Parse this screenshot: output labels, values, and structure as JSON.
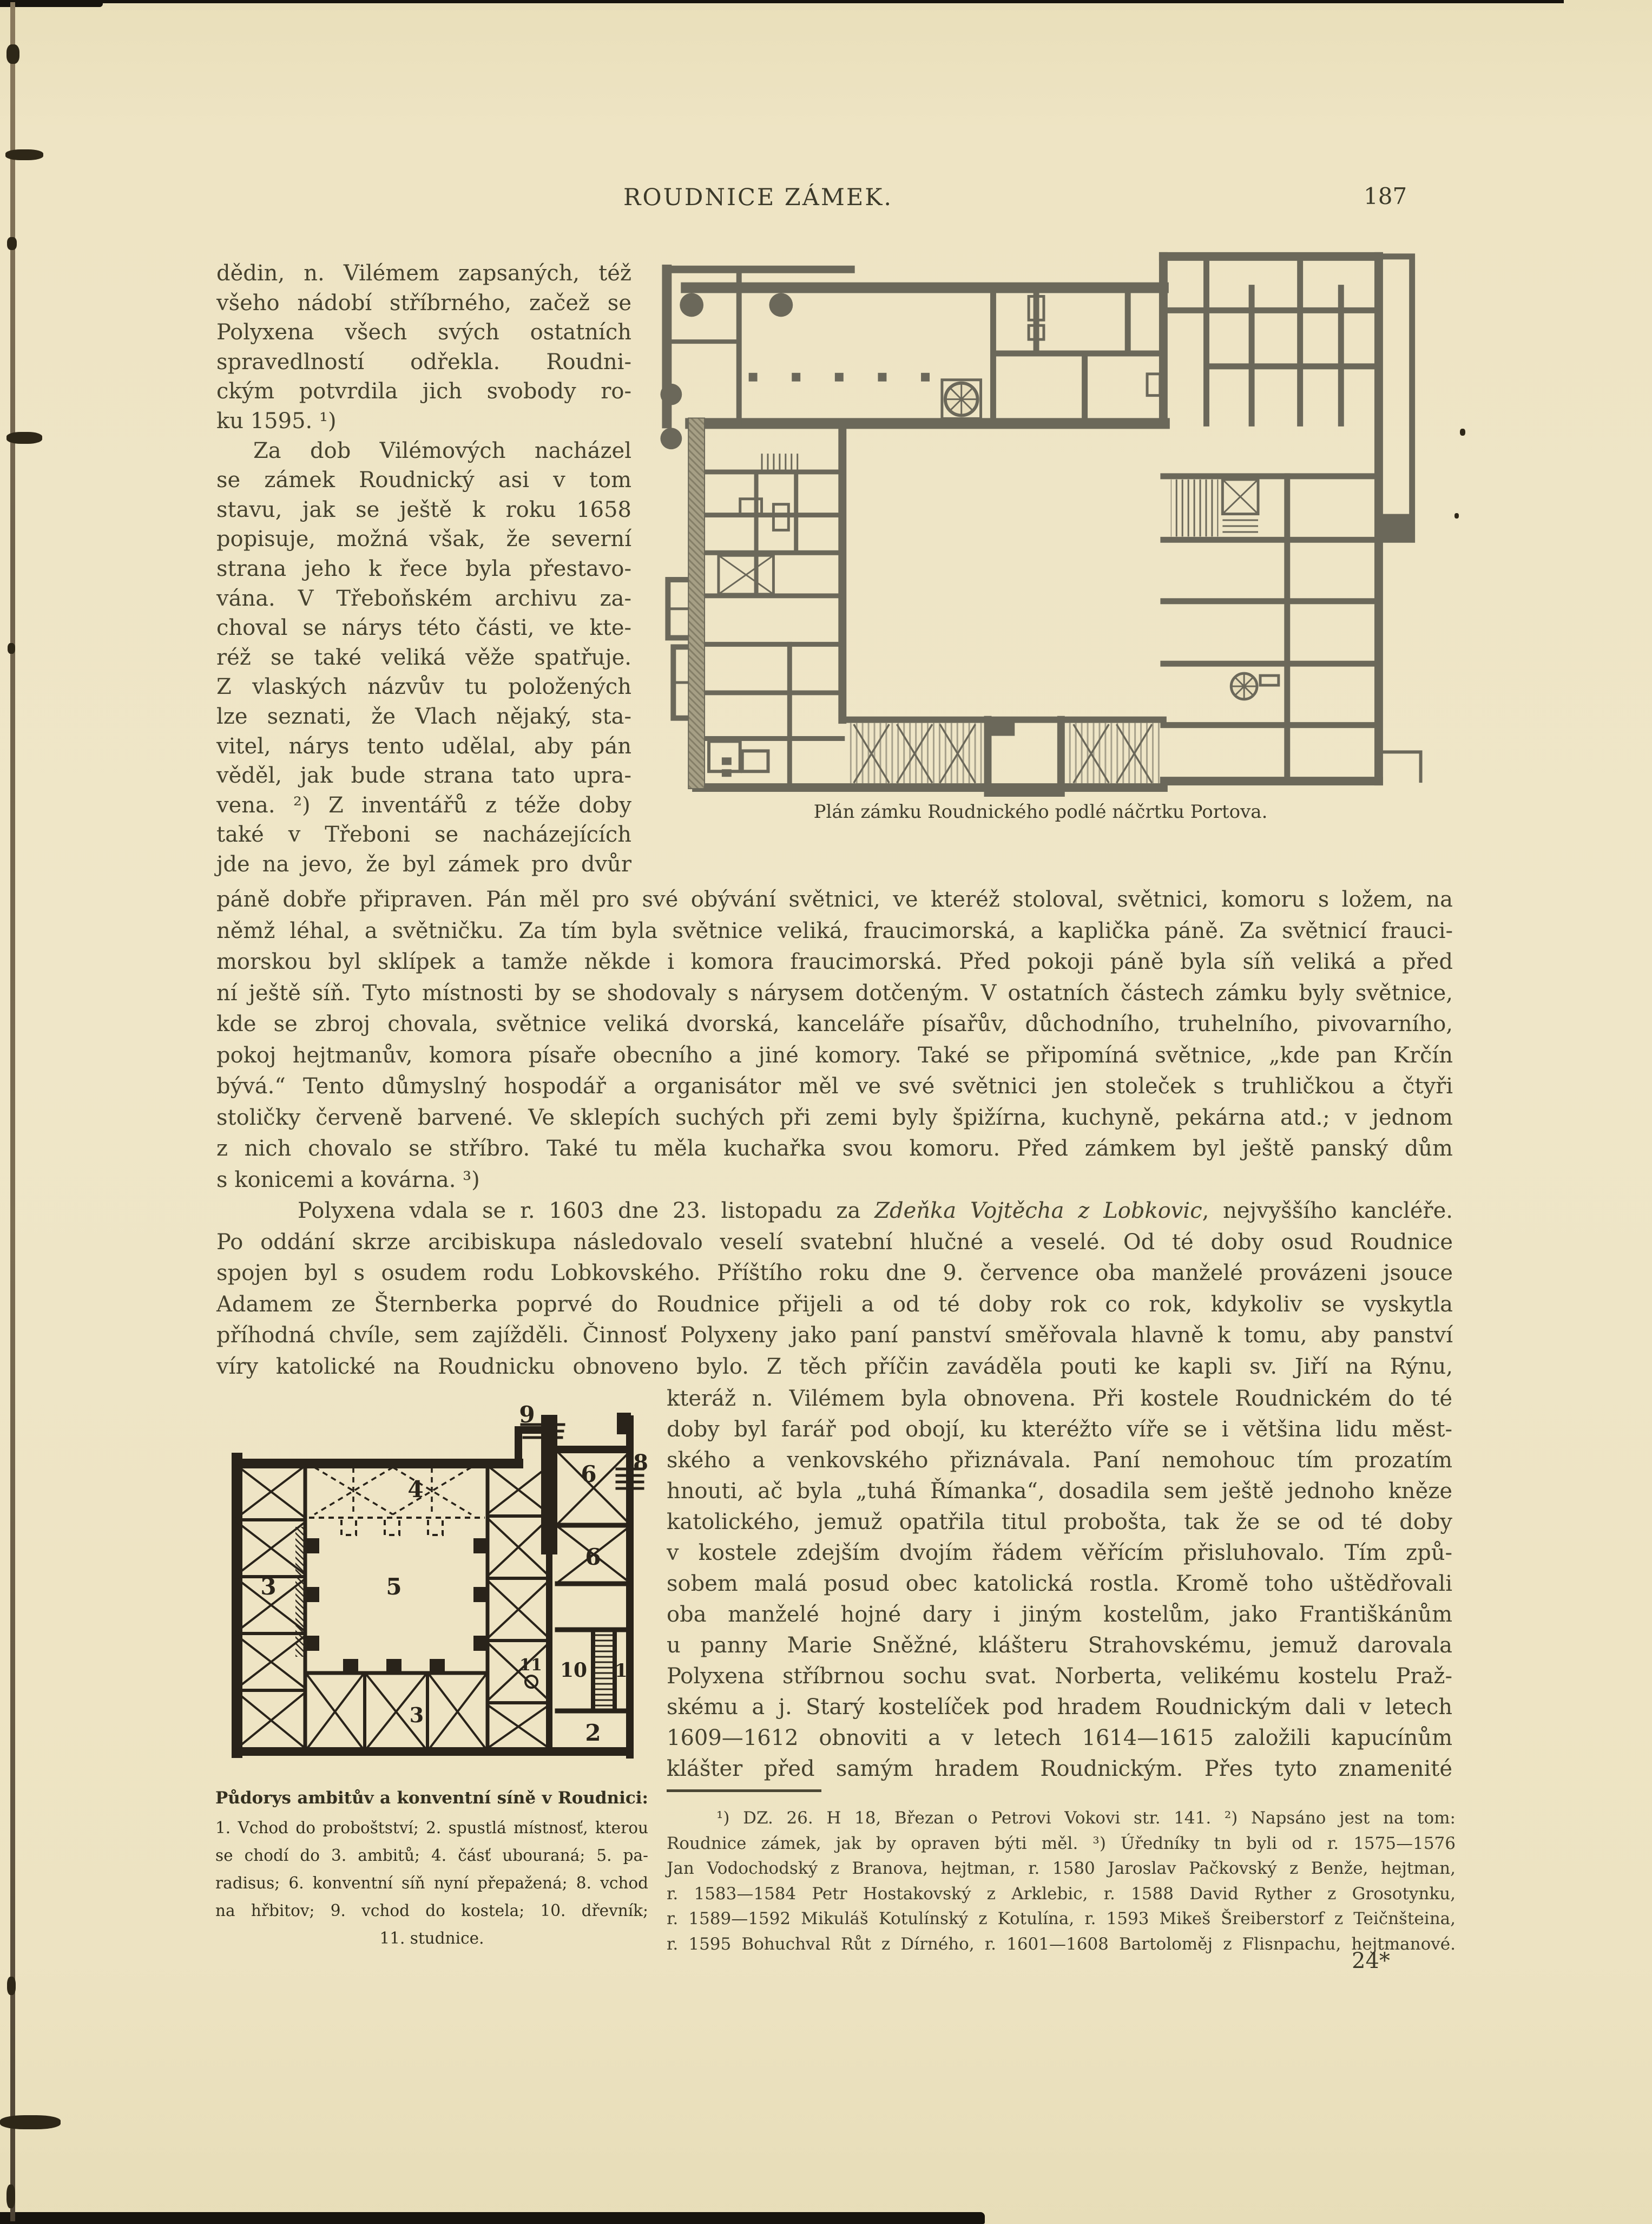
{
  "header": {
    "title": "ROUDNICE ZÁMEK.",
    "page_number": "187"
  },
  "colors": {
    "paper": "#eee4c4",
    "ink": "#46422f",
    "top_plan_wall": "#6b685a",
    "bottom_plan_wall": "#29231a"
  },
  "left_column": {
    "lines": [
      {
        "text": "dědin, n. Vilémem zapsaných, též"
      },
      {
        "text": "všeho nádobí stříbrného, začež se"
      },
      {
        "text": "Polyxena všech svých ostatních"
      },
      {
        "text": "spravedlností odřekla. Roudni-"
      },
      {
        "text": "ckým potvrdila jich svobody ro-"
      },
      {
        "text": "ku 1595. ¹)",
        "cls": "short"
      },
      {
        "text": "Za dob Vilémových nacházel",
        "cls": "indent"
      },
      {
        "text": "se zámek Roudnický asi v tom"
      },
      {
        "text": "stavu, jak se ještě k roku 1658"
      },
      {
        "text": "popisuje, možná však, že severní"
      },
      {
        "text": "strana jeho k řece byla přestavo-"
      },
      {
        "text": "vána. V Třeboňském archivu za-"
      },
      {
        "text": "choval se nárys této části, ve kte-"
      },
      {
        "text": "réž se také veliká věže spatřuje."
      },
      {
        "text": "Z vlaských názvův tu položených"
      },
      {
        "text": "lze seznati, že Vlach nějaký, sta-"
      },
      {
        "text": "vitel, nárys tento udělal, aby pán"
      },
      {
        "text": "věděl, jak bude strana tato upra-"
      },
      {
        "text": "vena. ²) Z inventářů z téže doby"
      },
      {
        "text": "také v Třeboni se nacházejících"
      },
      {
        "text": "jde na jevo, že byl zámek pro dvůr"
      }
    ]
  },
  "full_width": {
    "para1_lines": [
      {
        "text": "páně dobře připraven. Pán měl pro své obývání světnici, ve kteréž stoloval, světnici, komoru s ložem, na"
      },
      {
        "text": "němž léhal, a světničku. Za tím byla světnice veliká, fraucimorská, a kaplička páně. Za světnicí frauci-"
      },
      {
        "text": "morskou byl sklípek a tamže někde i komora fraucimorská. Před pokoji páně byla síň veliká a před"
      },
      {
        "text": "ní ještě síň. Tyto místnosti by se shodovaly s nárysem dotčeným. V ostatních částech zámku byly světnice,"
      },
      {
        "text": "kde se zbroj chovala, světnice veliká dvorská, kanceláře písařův, důchodního, truhelního, pivovarního,"
      },
      {
        "text": "pokoj hejtmanův, komora písaře obecního a jiné komory. Také se připomíná světnice, „kde pan Krčín"
      },
      {
        "text": "bývá.“ Tento důmyslný hospodář a organisátor měl ve své světnici jen stoleček s truhličkou a čtyři"
      },
      {
        "text": "stoličky červeně barvené. Ve sklepích suchých při zemi byly špižírna, kuchyně, pekárna atd.; v jednom"
      },
      {
        "text": "z nich chovalo se stříbro. Také tu měla kuchařka svou komoru. Před zámkem byl ještě panský dům"
      },
      {
        "text": "s konicemi a kovárna. ³)",
        "cls": "short"
      }
    ],
    "wedding_line": {
      "pre": "Polyxena vdala se r. 1603 dne 23. listopadu za ",
      "italic": "Zdeňka Vojtěcha z Lobkovic",
      "post": ", nejvyššího kancléře."
    },
    "para2_lines": [
      {
        "text": "Po oddání skrze arcibiskupa následovalo veselí svatební hlučné a veselé. Od té doby osud Roudnice"
      },
      {
        "text": "spojen byl s osudem rodu Lobkovského. Příštího roku dne 9. července oba manželé provázeni jsouce"
      },
      {
        "text": "Adamem ze Šternberka poprvé do Roudnice přijeli a od té doby rok co rok, kdykoliv se vyskytla"
      },
      {
        "text": "příhodná chvíle, sem zajížděli. Činnosť Polyxeny jako paní panství směřovala hlavně k tomu, aby panství"
      },
      {
        "text": "víry katolické na Roudnicku obnoveno bylo. Z těch příčin zaváděla pouti ke kapli sv. Jiří na Rýnu,"
      }
    ]
  },
  "right_column": {
    "lines": [
      {
        "text": "kteráž n. Vilémem byla obnovena. Při kostele Roudnickém do té"
      },
      {
        "text": "doby byl farář pod obojí, ku kteréžto víře se i většina lidu měst-"
      },
      {
        "text": "ského a venkovského přiznávala. Paní nemohouc tím prozatím"
      },
      {
        "text": "hnouti, ač byla „tuhá Římanka“, dosadila sem ještě jednoho kněze"
      },
      {
        "text": "katolického, jemuž opatřila titul probošta, tak že se od té doby"
      },
      {
        "text": "v kostele zdejším dvojím řádem věřícím přisluhovalo. Tím způ-"
      },
      {
        "text": "sobem malá posud obec katolická rostla. Kromě toho uštědřovali"
      },
      {
        "text": "oba manželé hojné dary i jiným kostelům, jako Františkánům"
      },
      {
        "text": "u panny Marie Sněžné, klášteru Strahovskému, jemuž darovala"
      },
      {
        "text": "Polyxena stříbrnou sochu svat. Norberta, velikému kostelu Praž-"
      },
      {
        "text": "skému a j. Starý kostelíček pod hradem Roudnickým dali v letech"
      },
      {
        "text": "1609—1612 obnoviti a v letech 1614—1615 založili kapucínům"
      },
      {
        "text": "klášter před samým hradem Roudnickým. Přes tyto znamenité"
      }
    ]
  },
  "plans": {
    "top": {
      "caption": "Plán zámku Roudnického podlé náčrtku Portova."
    },
    "bottom": {
      "caption_title": "Půdorys ambitův a konventní síně v Roudnici:",
      "legend_lines": [
        {
          "text": "1. Vchod do proboštství; 2. spustlá místnosť, kterou"
        },
        {
          "text": "se chodí do 3. ambitů; 4. čásť ubouraná; 5. pa-"
        },
        {
          "text": "radisus; 6. konventní síň nyní přepažená; 8. vchod"
        },
        {
          "text": "na hřbitov; 9. vchod do kostela; 10. dřevník;"
        },
        {
          "text": "11. studnice.",
          "cls": "center"
        }
      ],
      "labels": [
        "9",
        "4",
        "6",
        "8",
        "6",
        "3",
        "5",
        "10",
        "11",
        "1",
        "3",
        "2"
      ]
    }
  },
  "footnotes": {
    "lines": [
      {
        "text": "¹) DZ. 26. H 18, Březan o Petrovi Vokovi str. 141. ²) Napsáno jest na tom:",
        "cls": "indent-fn"
      },
      {
        "text": "Roudnice zámek, jak by opraven býti měl. ³) Úředníky tn byli od r. 1575—1576"
      },
      {
        "text": "Jan Vodochodský z Branova, hejtman, r. 1580 Jaroslav Pačkovský z Benže, hejtman,"
      },
      {
        "text": "r. 1583—1584 Petr Hostakovský z Arklebic, r. 1588 David Ryther z Grosotynku,"
      },
      {
        "text": "r. 1589—1592 Mikuláš Kotulínský z Kotulína, r. 1593 Mikeš Šreiberstorf z Teičnšteina,"
      },
      {
        "text": "r. 1595 Bohuchval Růt z Dírného, r. 1601—1608 Bartoloměj z Flisnpachu, hejtmanové."
      }
    ]
  },
  "signature": "24*"
}
